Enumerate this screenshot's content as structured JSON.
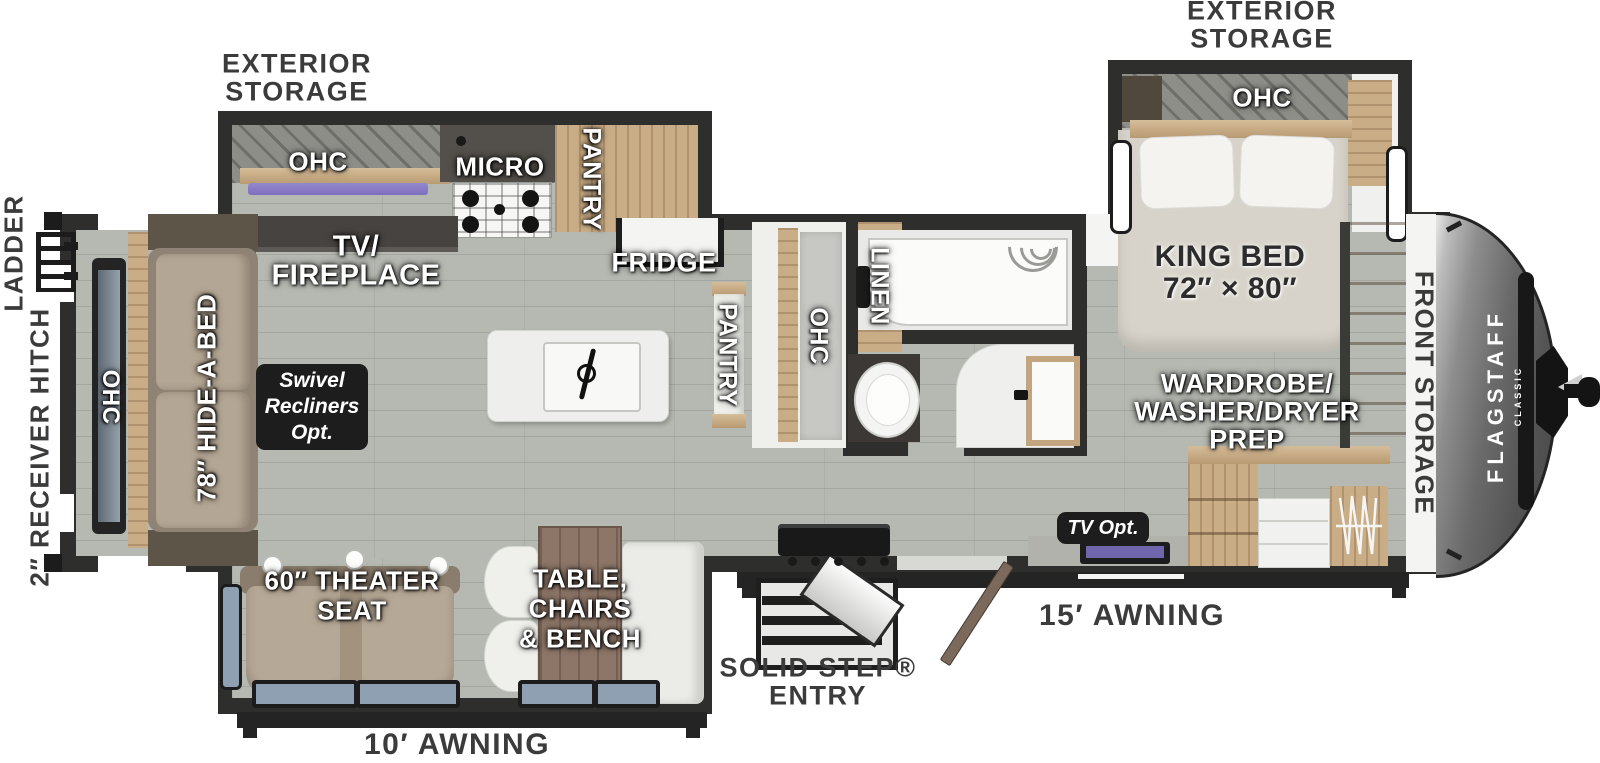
{
  "title": "Flagstaff Classic travel trailer floor plan",
  "brand": {
    "name": "FLAGSTAFF",
    "series": "CLASSIC"
  },
  "colors": {
    "floor": "#b6b9b2",
    "wall": "#2e2e2d",
    "wood": "#c9ad87",
    "front_cap": "#565656",
    "led_strip": "#8b7ec5",
    "option_box": "#1d1d1d",
    "exterior_text": "#3b3b3b"
  },
  "labels": {
    "exterior_storage_left": [
      "EXTERIOR",
      "STORAGE"
    ],
    "exterior_storage_right": [
      "EXTERIOR",
      "STORAGE"
    ],
    "ladder": "LADDER",
    "receiver_hitch": "2″ RECEIVER HITCH",
    "ohc_rear": "OHC",
    "hide_a_bed": "78″ HIDE-A-BED",
    "tv_fireplace": [
      "TV/",
      "FIREPLACE"
    ],
    "swivel_recliners": [
      "Swivel",
      "Recliners",
      "Opt."
    ],
    "theater_seat": [
      "60″ THEATER",
      "SEAT"
    ],
    "dinette": [
      "TABLE,",
      "CHAIRS",
      "& BENCH"
    ],
    "ohc_kitchen": "OHC",
    "micro": "MICRO",
    "pantry_slide": "PANTRY",
    "fridge": "FRIDGE",
    "pantry_main": "PANTRY",
    "ohc_bath": "OHC",
    "linen": "LINEN",
    "ohc_bedroom": "OHC",
    "king_bed": [
      "KING BED",
      "72″ × 80″"
    ],
    "wardrobe": [
      "WARDROBE/",
      "WASHER/DRYER",
      "PREP"
    ],
    "tv_opt": "TV Opt.",
    "front_storage": "FRONT STORAGE",
    "solid_step_entry": [
      "SOLID STEP®",
      "ENTRY"
    ],
    "awning_10": "10′ AWNING",
    "awning_15": "15′ AWNING"
  }
}
